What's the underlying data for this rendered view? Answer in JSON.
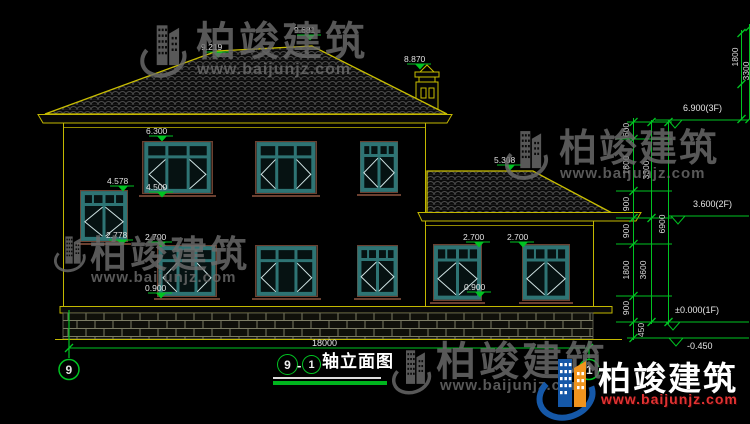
{
  "drawing": {
    "name": "⑨-①轴立面图",
    "axis_bubble_left": "9",
    "axis_bubble_right": "1",
    "title": {
      "axis_start": "9",
      "separator": "-",
      "axis_end": "1",
      "name": "轴立面图"
    },
    "total_width": "18000",
    "elevations": {
      "ridge_left": "9.219",
      "ridge_peak": "9.681",
      "chimney_top": "8.870",
      "main_eave": "6.300",
      "stair_window_top": "4.578",
      "f2_window_sill": "4.500",
      "stair_window_bottom": "2.778",
      "f1_window_head": "2.700",
      "f1_window_sill": "0.900",
      "annex_ridge": "5.308",
      "annex_window_head_l": "2.700",
      "annex_window_head_r": "2.700",
      "annex_window_sill": "0.900"
    },
    "levels": {
      "floor3": "6.900(3F)",
      "floor2": "3.600(2F)",
      "floor1": "±0.000(1F)",
      "ground": "-0.450"
    },
    "dims_inner": [
      "600",
      "1800",
      "900",
      "900",
      "1800",
      "900",
      "450"
    ],
    "dims_mid": [
      "3300",
      "3600"
    ],
    "dims_outer": [
      "6900"
    ],
    "dims_top_right": [
      "1800",
      "3300"
    ]
  },
  "watermark": {
    "brand": "柏竣建筑",
    "url": "www.baijunjz.com"
  },
  "colors": {
    "line_yellow": "#c9be00",
    "dim_green": "#00c322",
    "window_teal": "#2e7474",
    "logo_blue": "#1558a8",
    "logo_orange": "#f0941e",
    "url_red": "#e03232"
  }
}
